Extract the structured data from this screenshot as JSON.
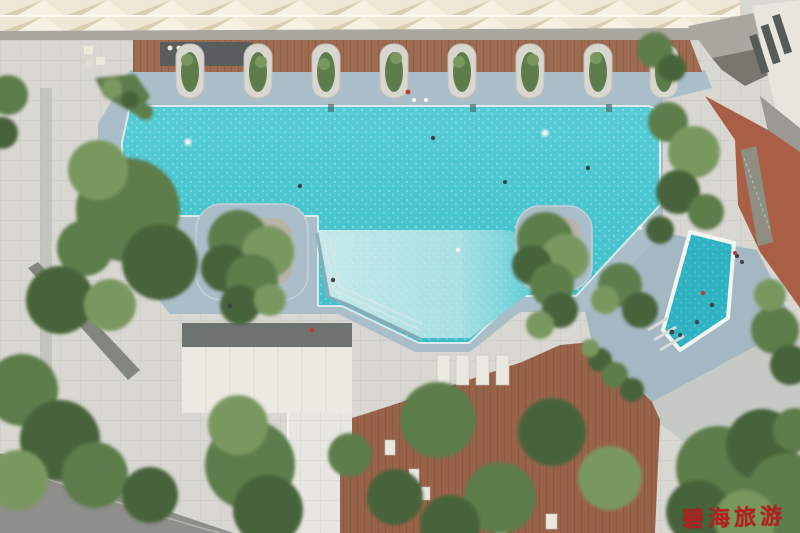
{
  "watermark": {
    "text": "碧海旅游"
  },
  "colors": {
    "paving": "#d8d7d1",
    "paving_bright": "#e7e6e0",
    "wet_deck": "#a9bec8",
    "wet_deck_dark": "#a3b8c2",
    "pool_deep": "#49c6d0",
    "pool_deep_light": "#5bd0d8",
    "pool_shallow": "#c3e8ea",
    "pool_kids": "#2fb3c3",
    "steps_band": "#8fa9b5",
    "wood_deck_top": "#9c6b50",
    "wood_deck_bottom": "#996349",
    "terracotta": "#a95f46",
    "roof_cream": "#eee7d5",
    "roof_shadow": "#d9cdb1",
    "roof_highlight": "#f6f1e2",
    "walkway_gray": "#aaa7a1",
    "road": "#8e8e8a",
    "canopy_white": "#ebe9e2",
    "canopy_dark": "#6e7370",
    "building_white": "#e7e5de",
    "window_dark": "#565a59",
    "tree_green": "#5d7d4b",
    "tree_green_light": "#79985f",
    "tree_green_dark": "#46633a",
    "island_bed": "#b9b4a8",
    "coping": "#dce9e9",
    "person_white": "#f4f2ea",
    "person_dark": "#3f4246",
    "person_red": "#c23a2e",
    "watermark_red": "#b41f1f"
  },
  "scene": {
    "type": "aerial-photograph",
    "description": "Top-down aerial photo of a resort pool courtyard: sawtooth skylight roof and wooden deck with shrub planters along the top, a large turquoise free-form swimming pool with a shallow lagoon and two tree islands, a triangular children's pool on the right, pale stone pool decks, a white canopy pavilion lower left, curved garden road, timber sun decks with loungers and trees at the bottom, terracotta terraces and a white residential tower on the right, red Chinese watermark at bottom right.",
    "regions": [
      "sawtooth-roof",
      "upper-wood-deck",
      "planter-row",
      "main-pool",
      "shallow-pool",
      "kids-pool",
      "island-planters",
      "pool-deck",
      "sun-loungers",
      "canopy-roof",
      "garden-road",
      "wood-sun-deck",
      "terracotta-terrace",
      "residential-tower",
      "trees",
      "swimmers",
      "watermark"
    ]
  }
}
